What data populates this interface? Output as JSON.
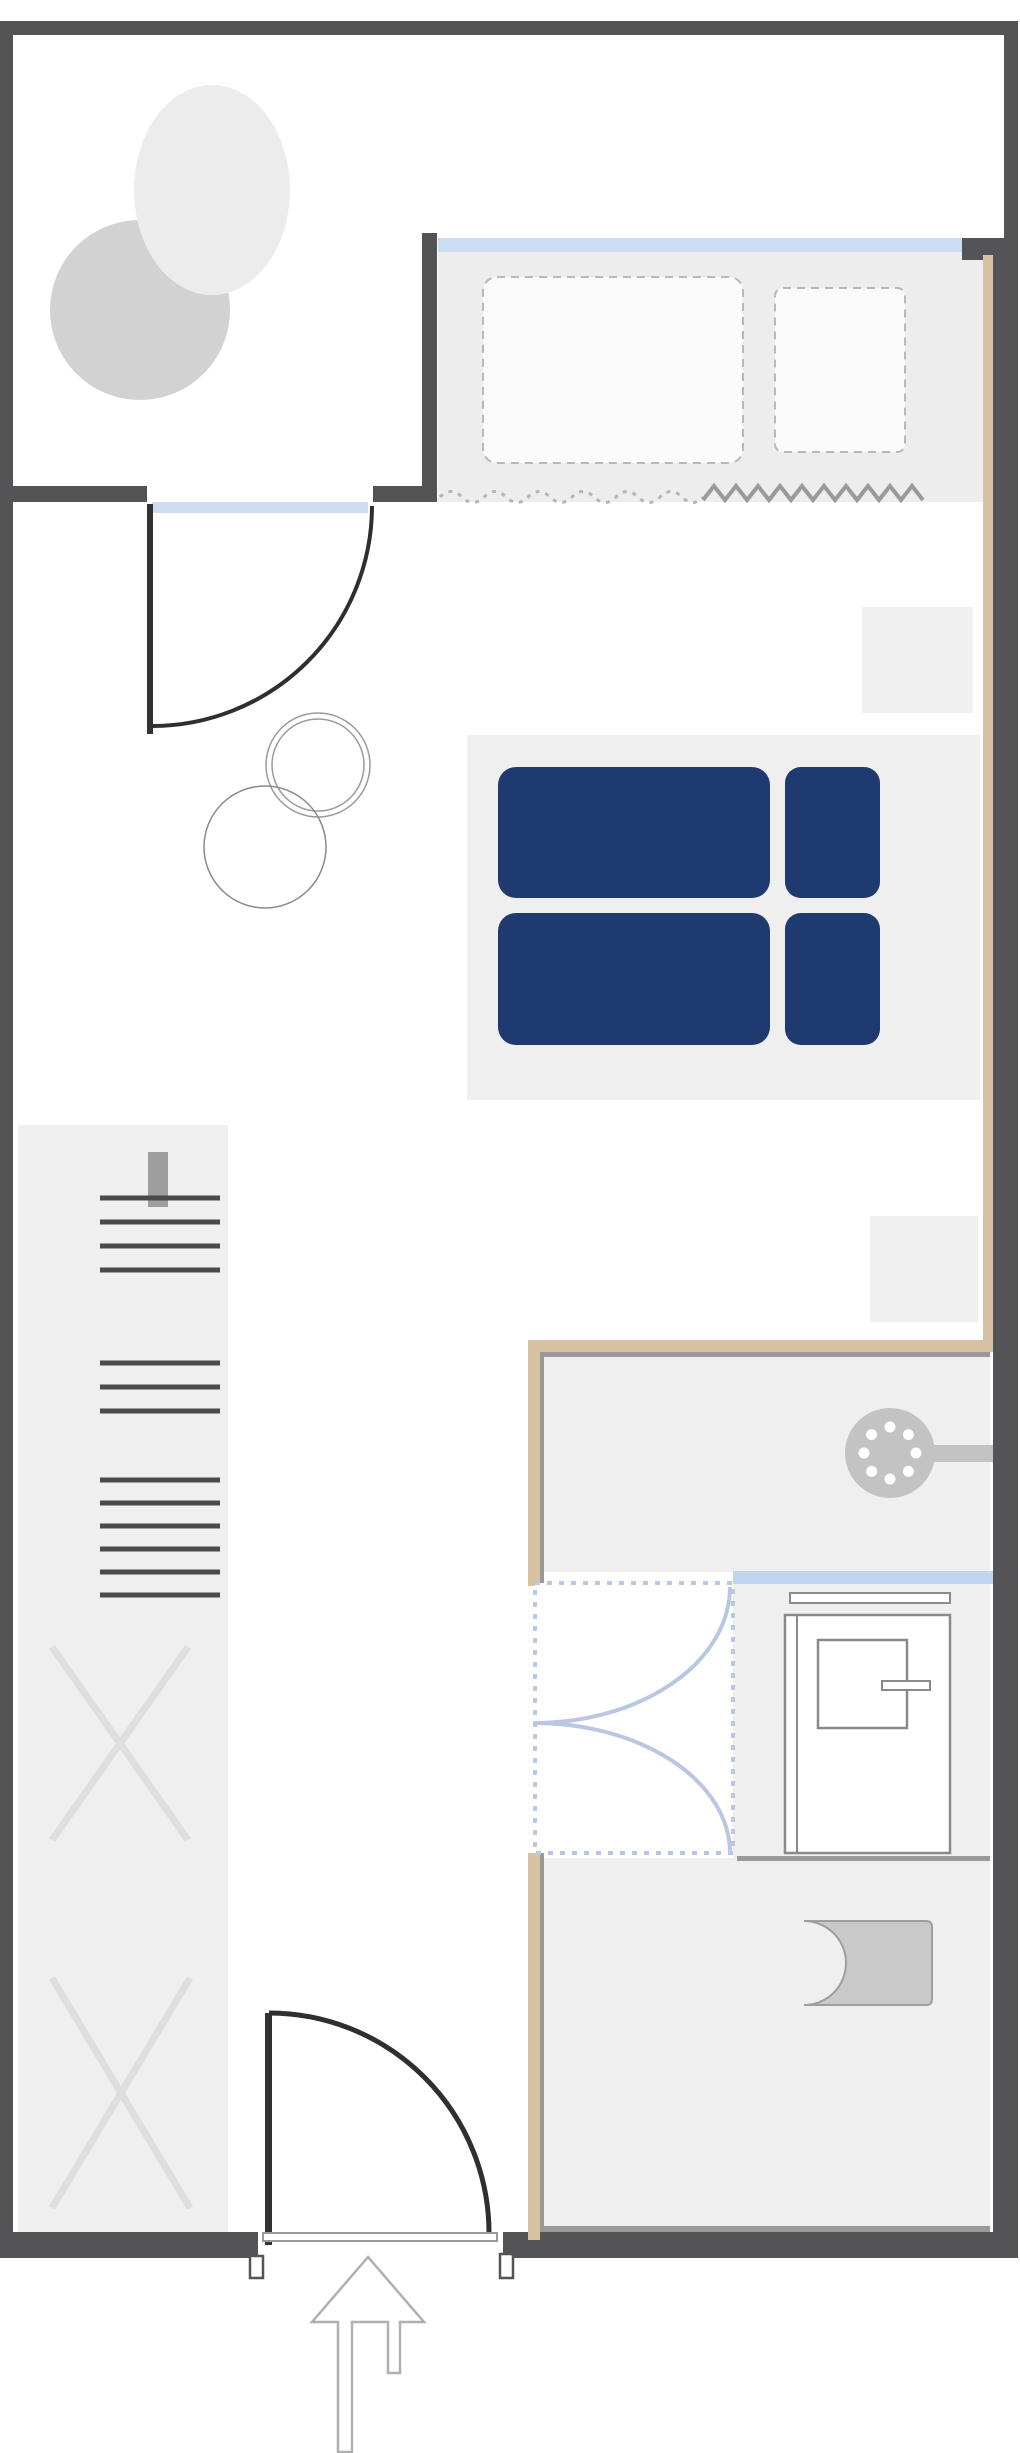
{
  "meta": {
    "kind": "floor-plan",
    "description": "studio apartment floor plan with balcony, bed, wardrobe, shower bathroom and entrance arrow",
    "background": "#ffffff"
  },
  "colors": {
    "wall_dark": "#545456",
    "wall_tan": "#d8c2a4",
    "wall_inner_line": "#9a9a9a",
    "window_blue": "#ccddf1",
    "glass_blue": "#c3d4ee",
    "glass_dashed_blue": "#b9c6e4",
    "floor_gray": "#efefef",
    "furniture_gray": "#d2d2d2",
    "bed_navy": "#1e3a6e",
    "fixture_gray": "#c3c3c3",
    "outline_gray": "#8a8a8a"
  },
  "canvas": {
    "width": 1020,
    "height": 2453
  },
  "shapes": [
    {
      "name": "window-alcove-floor",
      "type": "rect",
      "x": 438,
      "y": 252,
      "w": 545,
      "h": 250,
      "fill": "#ededed"
    },
    {
      "name": "bed-platform",
      "type": "rect",
      "x": 467,
      "y": 735,
      "w": 513,
      "h": 365,
      "fill": "#efefef"
    },
    {
      "name": "nightstand-top",
      "type": "rect",
      "x": 862,
      "y": 607,
      "w": 111,
      "h": 106,
      "fill": "#f0f0f0"
    },
    {
      "name": "nightstand-bottom",
      "type": "rect",
      "x": 870,
      "y": 1216,
      "w": 108,
      "h": 106,
      "fill": "#f0f0f0"
    },
    {
      "name": "wardrobe-panel",
      "type": "rect",
      "x": 18,
      "y": 1125,
      "w": 210,
      "h": 1107,
      "fill": "#efefef"
    },
    {
      "name": "shower-area-floor",
      "type": "rect",
      "x": 540,
      "y": 1352,
      "w": 450,
      "h": 220,
      "fill": "#efefef"
    },
    {
      "name": "bath-middle-floor",
      "type": "rect",
      "x": 733,
      "y": 1584,
      "w": 257,
      "h": 274,
      "fill": "#efefef"
    },
    {
      "name": "wc-area-floor",
      "type": "rect",
      "x": 540,
      "y": 1858,
      "w": 450,
      "h": 374,
      "fill": "#efefef"
    },
    {
      "name": "balcony-lounge-chair",
      "type": "circle",
      "cx": 140,
      "cy": 310,
      "r": 90,
      "fill": "#d2d2d2"
    },
    {
      "name": "balcony-table",
      "type": "ellipse",
      "cx": 212,
      "cy": 190,
      "rx": 78,
      "ry": 105,
      "fill": "#ececec"
    },
    {
      "name": "side-table-ring-outer",
      "type": "circle",
      "cx": 318,
      "cy": 765,
      "r": 52,
      "stroke": "#9a9a9a",
      "sw": 1.5
    },
    {
      "name": "side-table-ring-inner",
      "type": "circle",
      "cx": 318,
      "cy": 765,
      "r": 46,
      "stroke": "#9a9a9a",
      "sw": 1.5
    },
    {
      "name": "chair-ring",
      "type": "circle",
      "cx": 265,
      "cy": 847,
      "r": 61,
      "stroke": "#8a8a8a",
      "sw": 1.5
    },
    {
      "name": "hidden-furniture-outline-large",
      "type": "rect",
      "x": 483,
      "y": 277,
      "w": 260,
      "h": 186,
      "rx": 14,
      "fill": "#fbfbfb",
      "stroke": "#b8b8b8",
      "sw": 2,
      "dash": "8 6"
    },
    {
      "name": "hidden-furniture-outline-small",
      "type": "rect",
      "x": 775,
      "y": 288,
      "w": 130,
      "h": 164,
      "rx": 8,
      "fill": "#fbfbfb",
      "stroke": "#b8b8b8",
      "sw": 2,
      "dash": "8 6"
    },
    {
      "name": "curtain-dotted-wave",
      "type": "path",
      "d": "M 440 497 Q 451 486 462 497 T 484 497 T 506 497 T 528 497 T 550 497 T 572 497 T 594 497 T 616 497 T 638 497 T 660 497 T 682 497 T 703 497",
      "stroke": "#b5b5b5",
      "sw": 3,
      "dash": "4 6"
    },
    {
      "name": "curtain-zigzag",
      "type": "polyline",
      "points": "703,500 714,486 725,500 736,486 747,500 758,486 769,500 780,486 791,500 802,486 813,500 824,486 835,500 846,486 857,500 868,486 879,500 890,486 901,500 912,486 923,500",
      "stroke": "#9a9a9a",
      "sw": 4
    },
    {
      "name": "duvet-top",
      "type": "rect",
      "x": 498,
      "y": 767,
      "w": 272,
      "h": 131,
      "rx": 18,
      "fill": "#1e3a6e"
    },
    {
      "name": "pillow-top",
      "type": "rect",
      "x": 785,
      "y": 767,
      "w": 95,
      "h": 131,
      "rx": 16,
      "fill": "#1e3a6e"
    },
    {
      "name": "duvet-bottom",
      "type": "rect",
      "x": 498,
      "y": 913,
      "w": 272,
      "h": 132,
      "rx": 18,
      "fill": "#1e3a6e"
    },
    {
      "name": "pillow-bottom",
      "type": "rect",
      "x": 785,
      "y": 913,
      "w": 95,
      "h": 132,
      "rx": 16,
      "fill": "#1e3a6e"
    },
    {
      "name": "wardrobe-wall-tab",
      "type": "rect",
      "x": 148,
      "y": 1152,
      "w": 20,
      "h": 55,
      "fill": "#9e9e9e"
    },
    {
      "name": "wardrobe-shelf-lines-top",
      "type": "lines",
      "x1": 100,
      "x2": 220,
      "ys": [
        1198,
        1222,
        1246,
        1270
      ],
      "stroke": "#4a4a4a",
      "sw": 5
    },
    {
      "name": "wardrobe-shelf-lines-middle",
      "type": "lines",
      "x1": 100,
      "x2": 220,
      "ys": [
        1363,
        1387,
        1411
      ],
      "stroke": "#4a4a4a",
      "sw": 5
    },
    {
      "name": "wardrobe-shelf-lines-lower",
      "type": "lines",
      "x1": 100,
      "x2": 220,
      "ys": [
        1480,
        1503,
        1526,
        1549,
        1572,
        1595
      ],
      "stroke": "#4a4a4a",
      "sw": 5
    },
    {
      "name": "wardrobe-cross-top",
      "type": "cross",
      "x": 52,
      "y": 1647,
      "w": 136,
      "h": 193,
      "stroke": "#dedede",
      "sw": 7
    },
    {
      "name": "wardrobe-cross-bottom",
      "type": "cross",
      "x": 52,
      "y": 1978,
      "w": 138,
      "h": 230,
      "stroke": "#dedede",
      "sw": 7
    },
    {
      "name": "window-main",
      "type": "rect",
      "x": 438,
      "y": 238,
      "w": 524,
      "h": 14,
      "fill": "#ccddf1"
    },
    {
      "name": "balcony-door-sill",
      "type": "rect",
      "x": 152,
      "y": 502,
      "w": 216,
      "h": 11,
      "fill": "#ccddf1"
    },
    {
      "name": "shower-glass-screen",
      "type": "rect",
      "x": 733,
      "y": 1571,
      "w": 260,
      "h": 13,
      "fill": "#c3d4ee"
    },
    {
      "name": "wall-top",
      "type": "rect",
      "x": 0,
      "y": 21,
      "w": 1016,
      "h": 14,
      "fill": "#545456"
    },
    {
      "name": "wall-left",
      "type": "rect",
      "x": 0,
      "y": 21,
      "w": 13,
      "h": 2237,
      "fill": "#545456"
    },
    {
      "name": "wall-right-upper",
      "type": "rect",
      "x": 1004,
      "y": 21,
      "w": 14,
      "h": 220,
      "fill": "#545456"
    },
    {
      "name": "wall-right-main",
      "type": "rect",
      "x": 993,
      "y": 238,
      "w": 25,
      "h": 2020,
      "fill": "#545456"
    },
    {
      "name": "window-corner-block",
      "type": "rect",
      "x": 962,
      "y": 238,
      "w": 43,
      "h": 22,
      "fill": "#545456"
    },
    {
      "name": "balcony-partition-wall",
      "type": "rect",
      "x": 422,
      "y": 233,
      "w": 15,
      "h": 269,
      "fill": "#545456"
    },
    {
      "name": "balcony-wall-left",
      "type": "rect",
      "x": 13,
      "y": 486,
      "w": 134,
      "h": 16,
      "fill": "#545456"
    },
    {
      "name": "balcony-wall-stub",
      "type": "rect",
      "x": 373,
      "y": 486,
      "w": 64,
      "h": 16,
      "fill": "#545456"
    },
    {
      "name": "wall-bottom-left",
      "type": "rect",
      "x": 0,
      "y": 2232,
      "w": 258,
      "h": 26,
      "fill": "#545456"
    },
    {
      "name": "wall-bottom-right",
      "type": "rect",
      "x": 503,
      "y": 2232,
      "w": 515,
      "h": 26,
      "fill": "#545456"
    },
    {
      "name": "bath-wall-top-tan",
      "type": "rect",
      "x": 528,
      "y": 1340,
      "w": 465,
      "h": 12,
      "fill": "#d8c2a4"
    },
    {
      "name": "bath-wall-left-upper-tan",
      "type": "rect",
      "x": 528,
      "y": 1340,
      "w": 12,
      "h": 246,
      "fill": "#d8c2a4"
    },
    {
      "name": "bath-wall-left-lower-tan",
      "type": "rect",
      "x": 528,
      "y": 1853,
      "w": 12,
      "h": 387,
      "fill": "#d8c2a4"
    },
    {
      "name": "wall-right-tan-facing",
      "type": "rect",
      "x": 983,
      "y": 255,
      "w": 10,
      "h": 1085,
      "fill": "#d8c2a4"
    },
    {
      "name": "bath-wall-top-innerline",
      "type": "rect",
      "x": 540,
      "y": 1352,
      "w": 450,
      "h": 5,
      "fill": "#9a9a9a"
    },
    {
      "name": "bath-wall-left-upper-innerline",
      "type": "rect",
      "x": 540,
      "y": 1352,
      "w": 4,
      "h": 234,
      "fill": "#9a9a9a"
    },
    {
      "name": "bath-wall-left-lower-innerline",
      "type": "rect",
      "x": 540,
      "y": 1853,
      "w": 4,
      "h": 379,
      "fill": "#9a9a9a"
    },
    {
      "name": "bath-wall-bottom-innerline",
      "type": "rect",
      "x": 540,
      "y": 2226,
      "w": 450,
      "h": 6,
      "fill": "#9a9a9a"
    },
    {
      "name": "vanity-divider-line",
      "type": "rect",
      "x": 737,
      "y": 1856,
      "w": 253,
      "h": 5,
      "fill": "#9a9a9a"
    },
    {
      "name": "balcony-door-leaf",
      "type": "rect",
      "x": 147,
      "y": 504,
      "w": 6,
      "h": 230,
      "fill": "#333333"
    },
    {
      "name": "balcony-door-swing-arc",
      "type": "path",
      "d": "M 372 506 A 220 220 0 0 1 152 726",
      "stroke": "#2f2f2f",
      "sw": 4
    },
    {
      "name": "entrance-door-leaf",
      "type": "rect",
      "x": 265,
      "y": 2013,
      "w": 7,
      "h": 232,
      "fill": "#333333"
    },
    {
      "name": "entrance-door-swing-arc",
      "type": "path",
      "d": "M 269 2013 A 220 220 0 0 1 489 2233",
      "stroke": "#2f2f2f",
      "sw": 5
    },
    {
      "name": "entrance-threshold",
      "type": "rect",
      "x": 263,
      "y": 2233,
      "w": 234,
      "h": 8,
      "fill": "#ffffff",
      "stroke": "#9a9a9a",
      "sw": 2
    },
    {
      "name": "entrance-jamb-left",
      "type": "rect",
      "x": 250,
      "y": 2256,
      "w": 13,
      "h": 22,
      "fill": "#ffffff",
      "stroke": "#545456",
      "sw": 2.5
    },
    {
      "name": "entrance-jamb-right",
      "type": "rect",
      "x": 500,
      "y": 2254,
      "w": 13,
      "h": 24,
      "fill": "#ffffff",
      "stroke": "#545456",
      "sw": 2.5
    },
    {
      "name": "shower-head",
      "type": "circle",
      "cx": 890,
      "cy": 1453,
      "r": 45,
      "fill": "#c3c3c3"
    },
    {
      "name": "shower-head-nozzles",
      "type": "dots",
      "cx": 890,
      "cy": 1453,
      "ring": 26,
      "count": 8,
      "dotR": 5.5,
      "fill": "#ffffff"
    },
    {
      "name": "shower-arm",
      "type": "rect",
      "x": 930,
      "y": 1445,
      "w": 63,
      "h": 17,
      "fill": "#c3c3c3"
    },
    {
      "name": "shower-enclosure",
      "type": "rect",
      "x": 535,
      "y": 1583,
      "w": 198,
      "h": 270,
      "fill": "#ffffff",
      "stroke": "#b9c6e4",
      "sw": 4,
      "dash": "5 7"
    },
    {
      "name": "shower-door-arc-upper",
      "type": "path",
      "d": "M 730 1587 A 196 136 0 0 1 534 1723",
      "stroke": "#b9c6e4",
      "sw": 4
    },
    {
      "name": "shower-door-arc-lower",
      "type": "path",
      "d": "M 534 1723 A 196 130 0 0 1 730 1853",
      "stroke": "#b9c6e4",
      "sw": 4
    },
    {
      "name": "vanity-cabinet",
      "type": "rect",
      "x": 785,
      "y": 1615,
      "w": 165,
      "h": 238,
      "fill": "#ffffff",
      "stroke": "#8a8a8a",
      "sw": 2.5
    },
    {
      "name": "vanity-cabinet-edge",
      "type": "line",
      "x1": 797,
      "y1": 1615,
      "x2": 797,
      "y2": 1853,
      "stroke": "#8a8a8a",
      "sw": 2
    },
    {
      "name": "towel-rail",
      "type": "rect",
      "x": 790,
      "y": 1593,
      "w": 160,
      "h": 10,
      "fill": "#ffffff",
      "stroke": "#8a8a8a",
      "sw": 2
    },
    {
      "name": "sink-basin",
      "type": "rect",
      "x": 818,
      "y": 1640,
      "w": 89,
      "h": 88,
      "fill": "#ffffff",
      "stroke": "#8a8a8a",
      "sw": 2.5
    },
    {
      "name": "sink-faucet",
      "type": "rect",
      "x": 882,
      "y": 1681,
      "w": 48,
      "h": 9,
      "fill": "#ffffff",
      "stroke": "#8a8a8a",
      "sw": 2
    },
    {
      "name": "toilet",
      "type": "path",
      "d": "M 804 1921 L 926 1921 Q 932 1921 932 1927 L 932 1999 Q 932 2005 926 2005 L 804 2005 A 42 42 0 0 0 804 1921 Z",
      "fill": "#c9c9c9",
      "stroke": "#9e9e9e",
      "sw": 2
    },
    {
      "name": "entrance-arrow",
      "type": "path",
      "d": "M 368 2257 L 424 2322 L 400 2322 L 400 2373 L 388 2373 L 388 2322 L 352 2322 L 352 2452 L 338 2452 L 338 2322 L 312 2322 Z",
      "fill": "#ffffff",
      "stroke": "#b0b0b0",
      "sw": 2.5
    }
  ]
}
